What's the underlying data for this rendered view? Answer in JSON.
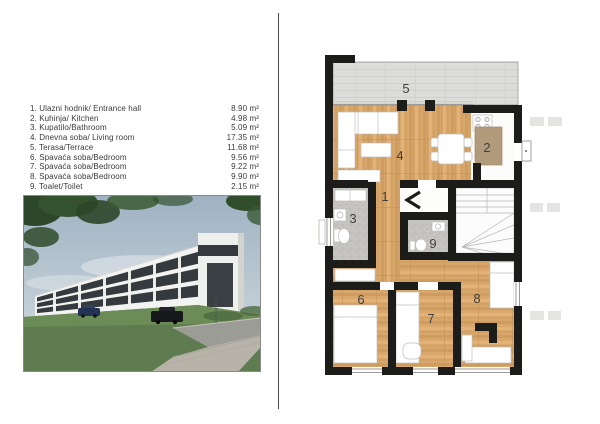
{
  "room_list": {
    "rows": [
      {
        "label": "1. Ulazni hodnik/ Entrance hall",
        "area": "8.90 m²"
      },
      {
        "label": "2. Kuhinja/ Kitchen",
        "area": "4.98 m²"
      },
      {
        "label": "3. Kupatilo/Bathroom",
        "area": "5.09 m²"
      },
      {
        "label": "4. Dnevna soba/ Living room",
        "area": "17.35 m²"
      },
      {
        "label": "5. Terasa/Terrace",
        "area": "11.68 m²"
      },
      {
        "label": "6. Spavaća soba/Bedroom",
        "area": "9.56 m²"
      },
      {
        "label": "7. Spavaća soba/Bedroom",
        "area": "9.22 m²"
      },
      {
        "label": "8. Spavaća soba/Bedroom",
        "area": "9.90 m²"
      },
      {
        "label": "9. Toalet/Toilet",
        "area": "2.15 m²"
      }
    ]
  },
  "plan": {
    "labels": {
      "r1": "1",
      "r2": "2",
      "r3": "3",
      "r4": "4",
      "r5": "5",
      "r6": "6",
      "r7": "7",
      "r8": "8",
      "r9": "9"
    }
  },
  "photo": {
    "alt": "3D street rendering of a long white residential building with dark window bands, lawn, sidewalk, road and parked cars"
  },
  "colors": {
    "wall": "#1c1c1a",
    "wood": "#d9a76c",
    "tile": "#cbc9c6",
    "terrace": "#dcdcd9",
    "rug": "#b29a7d",
    "text": "#3a3a3a",
    "divider": "#4a4a4a"
  }
}
